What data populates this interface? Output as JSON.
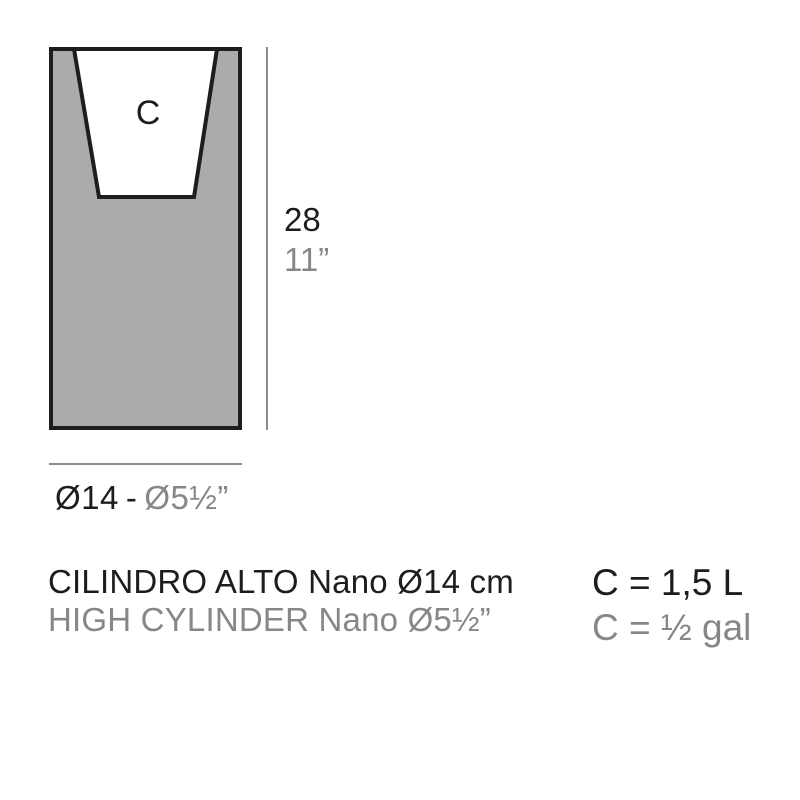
{
  "colors": {
    "ink": "#1d1d1b",
    "muted": "#878787",
    "pot_fill": "#ababab",
    "cavity_fill": "#ffffff",
    "dim_line": "#8c8c8c"
  },
  "diagram": {
    "cavity_label": "C",
    "height": {
      "cm": "28",
      "inches": "11”"
    },
    "diameter": {
      "cm": "Ø14",
      "separator": "-",
      "inches": "Ø5½”"
    }
  },
  "product": {
    "name_es": "CILINDRO ALTO Nano Ø14 cm",
    "name_en": "HIGH CYLINDER Nano Ø5½”"
  },
  "capacity": {
    "liters": "C = 1,5 L",
    "gallons": "C = ½ gal"
  }
}
